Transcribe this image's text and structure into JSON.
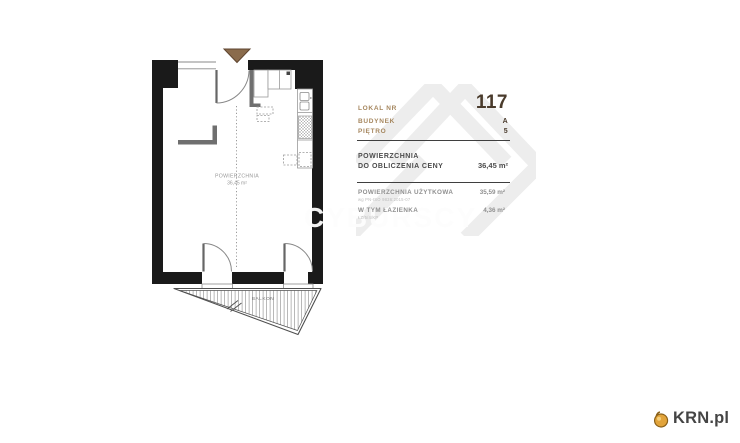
{
  "watermark": {
    "agency_text": "CYBURSCY"
  },
  "floor_plan": {
    "room_area_label": "POWIERZCHNIA",
    "room_area_value": "36,45 m²",
    "balcony_label": "BALKON"
  },
  "info_panel": {
    "rows": [
      {
        "label": "LOKAL NR",
        "value": "117"
      },
      {
        "label": "BUDYNEK",
        "value": "A"
      },
      {
        "label": "PIĘTRO",
        "value": "5"
      }
    ],
    "price_area_label_line1": "POWIERZCHNIA",
    "price_area_label_line2": "DO OBLICZENIA CENY",
    "price_area_value": "36,45 m²",
    "usable_area_label": "POWIERZCHNIA UŻYTKOWA",
    "usable_area_footnote": "wg PN-ISO 9836:2015-07",
    "usable_area_value": "35,59 m²",
    "bathroom_label": "W TYM ŁAZIENKA",
    "bathroom_footnote": "ŁZ/5/4/KP",
    "bathroom_value": "4,36 m²"
  },
  "branding": {
    "portal_name": "KRN.pl"
  },
  "colors": {
    "label_accent": "#a6875f",
    "value_dark": "#4a3b2c",
    "entrance_arrow": "#8a6b4c",
    "watermark_gray": "#ededed",
    "logo_gold": "#e2a43b",
    "wall_black": "#1a1a1a"
  }
}
